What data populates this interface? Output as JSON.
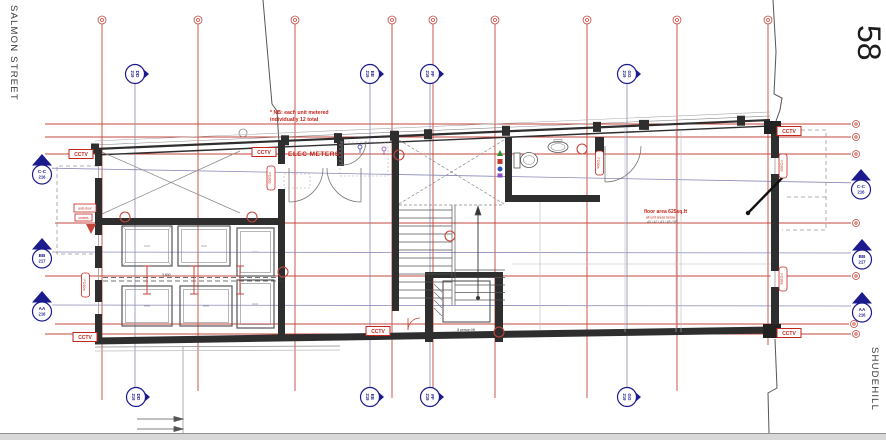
{
  "drawing": {
    "street_left": "SALMON STREET",
    "street_right": "SHUDEHILL",
    "building_number": "58"
  },
  "notes": {
    "nb_line1": "* NB: each unit metered",
    "nb_line2": "individually 12 total",
    "elec_meters": "ELEC METERS",
    "floor_area_line1": "floor area 625sq.ft",
    "floor_area_line2": "all unit areas below",
    "floor_area_line3": "40 / 42 / 43 / 45 / 50"
  },
  "labels": {
    "cctv": "CCTV",
    "auto_door": "auto door",
    "comms": "comms",
    "fire_door_tag": "FD30s",
    "parking_dim": "3,600",
    "lift": "8 person lift"
  },
  "section_markers": {
    "horizontal": [
      {
        "id": "C-C",
        "sheet": "216"
      },
      {
        "id": "BB",
        "sheet": "217"
      },
      {
        "id": "AA",
        "sheet": "216"
      }
    ],
    "vertical": [
      {
        "id": "DD",
        "sheet": "219"
      },
      {
        "id": "EE",
        "sheet": "219"
      },
      {
        "id": "FF",
        "sheet": "219"
      },
      {
        "id": "GG",
        "sheet": "219"
      }
    ]
  },
  "colors": {
    "grid_red": "#c4453c",
    "annotation_red": "#c2261c",
    "section_blue": "#1b1b8e",
    "section_line": "#8a8ab8",
    "wall": "#2e2e2e",
    "scrollband": "#d8d8d8"
  }
}
